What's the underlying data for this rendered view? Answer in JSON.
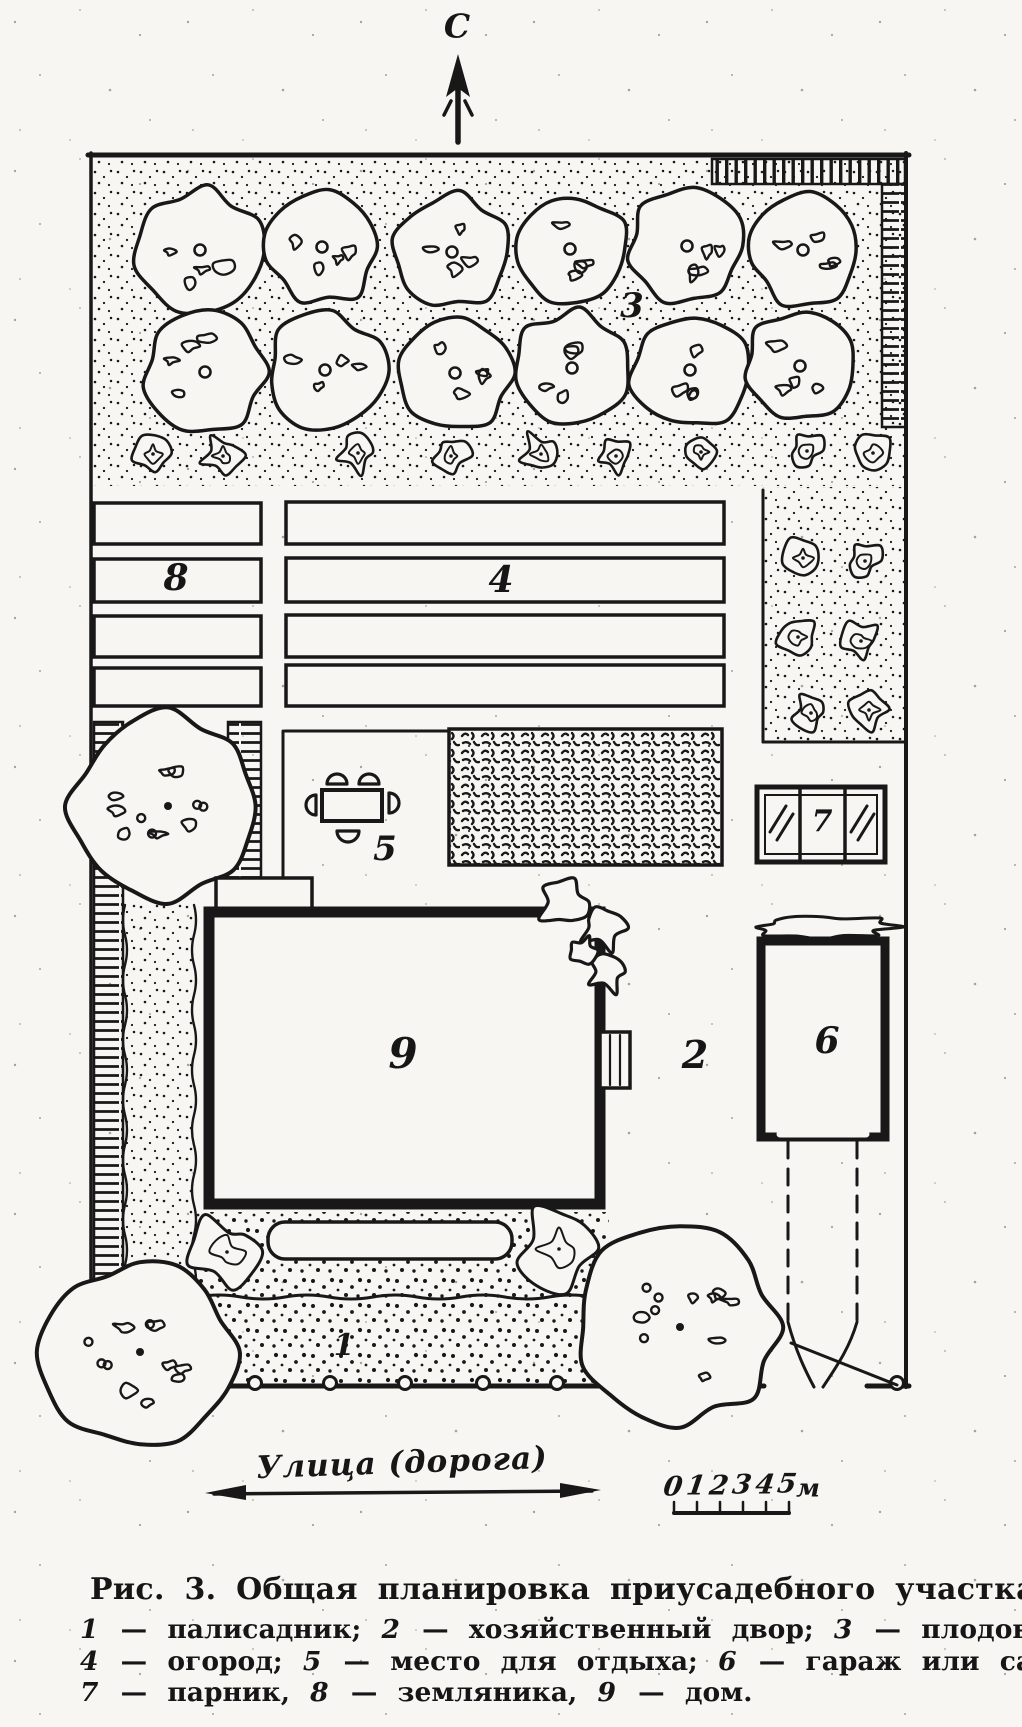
{
  "colors": {
    "ink": "#181818",
    "paper": "#f7f6f2"
  },
  "plan": {
    "north_label": "С",
    "street_label": "Улица (дорога)",
    "areas": {
      "front_garden": {
        "num": "1"
      },
      "yard": {
        "num": "2"
      },
      "orchard": {
        "num": "3"
      },
      "vegetable_garden": {
        "num": "4"
      },
      "rest_area": {
        "num": "5"
      },
      "garage": {
        "num": "6"
      },
      "greenhouse": {
        "num": "7"
      },
      "strawberries": {
        "num": "8"
      },
      "house": {
        "num": "9"
      }
    }
  },
  "scale_bar": {
    "values": [
      "0",
      "1",
      "2",
      "3",
      "4",
      "5"
    ],
    "unit": "м"
  },
  "figure_caption": {
    "title": "Рис. 3. Общая планировка приусадебного участка:",
    "legend_lines": [
      [
        {
          "num": "1",
          "text": " — палисадник; "
        },
        {
          "num": "2",
          "text": " — хозяйственный двор; "
        },
        {
          "num": "3",
          "text": " — плодовый сад;"
        }
      ],
      [
        {
          "num": "4",
          "text": " — огород; "
        },
        {
          "num": "5",
          "text": " — место для отдыха; "
        },
        {
          "num": "6",
          "text": " — гараж или сарай;"
        }
      ],
      [
        {
          "num": "7",
          "text": " — парник, "
        },
        {
          "num": "8",
          "text": " — земляника, "
        },
        {
          "num": "9",
          "text": " — дом."
        }
      ]
    ]
  }
}
